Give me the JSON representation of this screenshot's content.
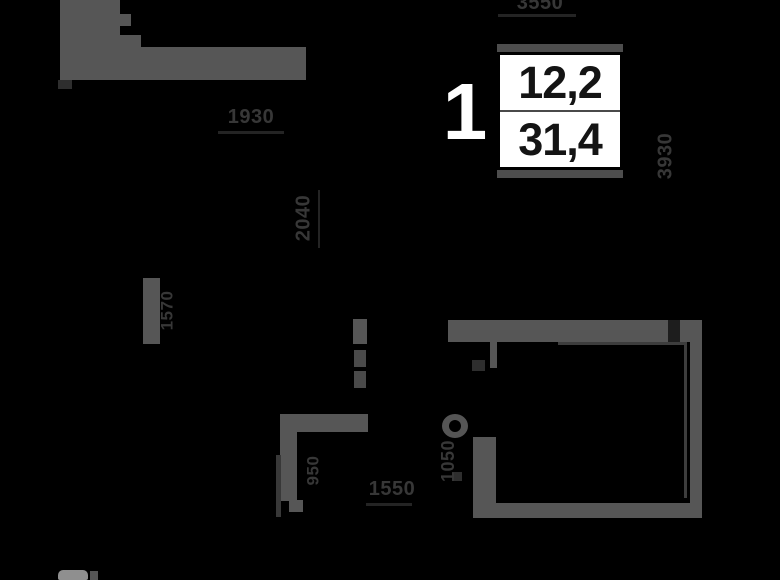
{
  "title": "1-room apartment floor plan",
  "badge": {
    "rooms": "1",
    "area_living": "12,2",
    "area_total": "31,4"
  },
  "dims": [
    {
      "id": "top",
      "text": "3550"
    },
    {
      "id": "upper-left",
      "text": "1930"
    },
    {
      "id": "left-upper",
      "text": "2040"
    },
    {
      "id": "left-mid",
      "text": "1570"
    },
    {
      "id": "right",
      "text": "3930"
    },
    {
      "id": "mid",
      "text": "1050"
    },
    {
      "id": "hall",
      "text": "950"
    },
    {
      "id": "bottom",
      "text": "1550"
    }
  ],
  "colors": {
    "background": "#000000",
    "wall": "#565656",
    "dim_text": "#373737",
    "badge_bg": "#ffffff",
    "badge_text": "#141414"
  }
}
